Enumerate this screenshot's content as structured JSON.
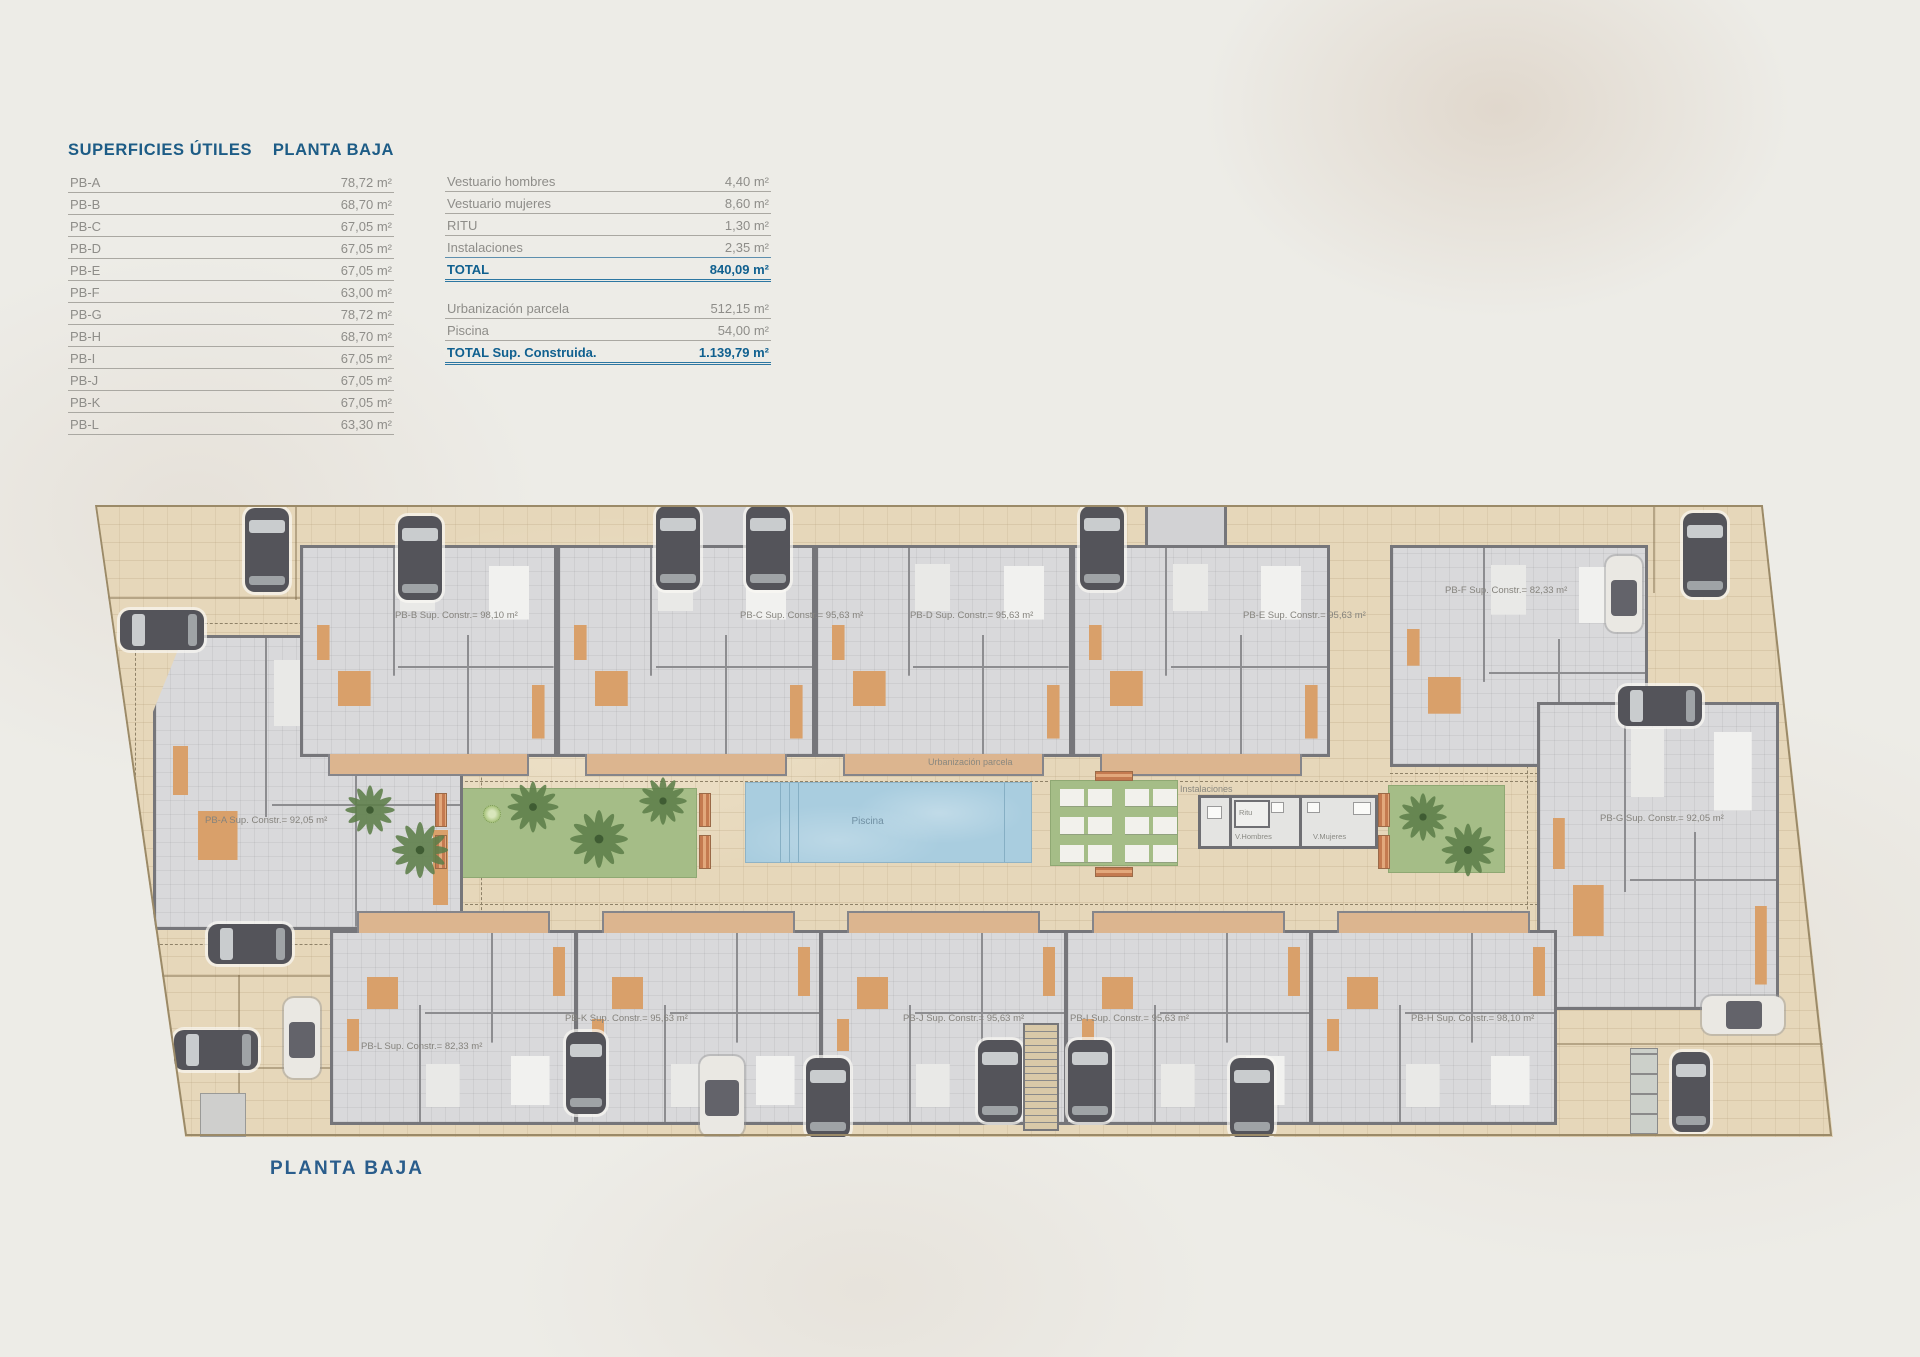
{
  "page": {
    "bottom_title": "PLANTA BAJA"
  },
  "tables": {
    "main": {
      "header_left": "SUPERFICIES ÚTILES",
      "header_right": "PLANTA BAJA",
      "rows": [
        {
          "label": "PB-A",
          "value": "78,72 m²"
        },
        {
          "label": "PB-B",
          "value": "68,70 m²"
        },
        {
          "label": "PB-C",
          "value": "67,05 m²"
        },
        {
          "label": "PB-D",
          "value": "67,05 m²"
        },
        {
          "label": "PB-E",
          "value": "67,05 m²"
        },
        {
          "label": "PB-F",
          "value": "63,00 m²"
        },
        {
          "label": "PB-G",
          "value": "78,72 m²"
        },
        {
          "label": "PB-H",
          "value": "68,70 m²"
        },
        {
          "label": "PB-I",
          "value": "67,05 m²"
        },
        {
          "label": "PB-J",
          "value": "67,05 m²"
        },
        {
          "label": "PB-K",
          "value": "67,05 m²"
        },
        {
          "label": "PB-L",
          "value": "63,30 m²"
        }
      ]
    },
    "extras": {
      "rows": [
        {
          "label": "Vestuario hombres",
          "value": "4,40 m²"
        },
        {
          "label": "Vestuario mujeres",
          "value": "8,60 m²"
        },
        {
          "label": "RITU",
          "value": "1,30 m²"
        },
        {
          "label": "Instalaciones",
          "value": "2,35 m²"
        }
      ],
      "total": {
        "label": "TOTAL",
        "value": "840,09 m²"
      },
      "rows2": [
        {
          "label": "Urbanización parcela",
          "value": "512,15 m²"
        },
        {
          "label": "Piscina",
          "value": "54,00 m²"
        }
      ],
      "total2": {
        "label": "TOTAL Sup. Construida.",
        "value": "1.139,79 m²"
      }
    }
  },
  "plan": {
    "units": [
      {
        "id": "PB-A",
        "label": "PB-A Sup. Constr.= 92,05 m²"
      },
      {
        "id": "PB-B",
        "label": "PB-B Sup. Constr.= 98,10 m²"
      },
      {
        "id": "PB-C",
        "label": "PB-C Sup. Constr.= 95,63 m²"
      },
      {
        "id": "PB-D",
        "label": "PB-D Sup. Constr.= 95,63 m²"
      },
      {
        "id": "PB-E",
        "label": "PB-E Sup. Constr.= 95,63 m²"
      },
      {
        "id": "PB-F",
        "label": "PB-F Sup. Constr.= 82,33 m²"
      },
      {
        "id": "PB-G",
        "label": "PB-G Sup. Constr.= 92,05 m²"
      },
      {
        "id": "PB-H",
        "label": "PB-H Sup. Constr.= 98,10 m²"
      },
      {
        "id": "PB-I",
        "label": "PB-I Sup. Constr.= 95,63 m²"
      },
      {
        "id": "PB-J",
        "label": "PB-J Sup. Constr.= 95,63 m²"
      },
      {
        "id": "PB-K",
        "label": "PB-K Sup. Constr.= 95,63 m²"
      },
      {
        "id": "PB-L",
        "label": "PB-L Sup. Constr.= 82,33 m²"
      }
    ],
    "labels": {
      "urbanizacion": "Urbanización parcela",
      "piscina": "Piscina",
      "instalaciones": "Instalaciones",
      "ritu": "Ritu",
      "v_hombres": "V.Hombres",
      "v_mujeres": "V.Mujeres"
    }
  },
  "colors": {
    "accent_blue": "#10608f",
    "text_gray": "#8e8d89",
    "parcel_tan": "#e6d7ba",
    "pool_blue": "#a9cddf",
    "garden_green": "#a5bd87",
    "terracotta": "#d9a06a"
  }
}
